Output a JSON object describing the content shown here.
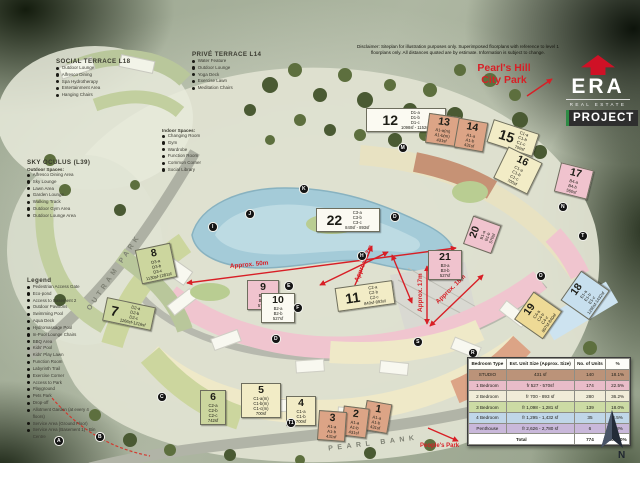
{
  "disclaimer": "Disclaimer: Siteplan for illustration purposes only. Superimposed floorplans with reference to level 1 floorplans only. All distances quoted are by estimate. Information is subject to change.",
  "branding": {
    "era": "ERA",
    "real_estate": "REAL ESTATE",
    "project": "PROJECT"
  },
  "park_labels": {
    "pearls_hill": "Pearl's Hill\nCity Park",
    "peoples_park": "People's Park"
  },
  "roads": {
    "outram": "OUTRAM PARK",
    "pearl_bank": "PEARL BANK"
  },
  "social_terrace": {
    "title": "SOCIAL TERRACE L18",
    "items": [
      "Outdoor Lounge",
      "Alfresco Dining",
      "Spa Hydrotherapy",
      "Entertainment Area",
      "Hanging Chairs"
    ]
  },
  "prive_terrace": {
    "title": "PRIVÉ TERRACE L14",
    "items": [
      "Water Feature",
      "Outdoor Lounge",
      "Yoga Deck",
      "Exercise Lawn",
      "Meditation Chairs"
    ]
  },
  "indoor_spaces": {
    "title": "Indoor Spaces:",
    "items": [
      "Changing Room",
      "Gym",
      "Wardrobe",
      "Function Room",
      "Common Corner",
      "Social Library"
    ]
  },
  "sky_oculus": {
    "title": "SKY OCULUS (L39)",
    "subtitle": "Outdoor Spaces:",
    "items": [
      "Alfresco Dining Area",
      "Sky Lounge",
      "Lawn Area",
      "Garden Lounge",
      "Walking Track",
      "Outdoor Gym Area",
      "Outdoor Lounge Area"
    ]
  },
  "legend": {
    "title": "Legend",
    "items": [
      "Pedestrian Access Gate",
      "Eco-pond",
      "Access to Basement 2",
      "Outdoor Pavilions",
      "Swimming Pool",
      "Aqua Deck",
      "Hydromassage Pool",
      "In-Pool Lounge Chairs",
      "BBQ Area",
      "Kids' Pool",
      "Kids' Play Lawn",
      "Function Room",
      "Labyrinth Trail",
      "Exercise Corner",
      "Access to Park",
      "Playground",
      "Pets Park",
      "Drop-off",
      "Allotment Garden (at every 4 floors)",
      "Service Area (Ground Floor)",
      "Service Area (Basement 1) - Bin Centre"
    ]
  },
  "compass": {
    "label": "N"
  },
  "colors": {
    "accent_red": "#d81f26",
    "era_red": "#cf1126",
    "project_green": "#2e8b44"
  },
  "table": {
    "headers": [
      "Bedroom Type",
      "Est. Unit Size (Approx. Size)",
      "No. of Units",
      "%"
    ],
    "rows": [
      {
        "type": "STUDIO",
        "size": "431 sf",
        "units": "140",
        "pct": "18.1%",
        "color": "#bb9379"
      },
      {
        "type": "1 Bedroom",
        "size": "fr 527 - 570sf",
        "units": "174",
        "pct": "22.5%",
        "color": "#e9bcc9"
      },
      {
        "type": "2 Bedroom",
        "size": "fr 700 - 893 sf",
        "units": "280",
        "pct": "36.2%",
        "color": "#f0ecd8"
      },
      {
        "type": "3 Bedroom",
        "size": "fr 1,098 - 1,281 sf",
        "units": "139",
        "pct": "18.0%",
        "color": "#ccdba4"
      },
      {
        "type": "4 Bedroom",
        "size": "fr 1,295 - 1,432 sf",
        "units": "35",
        "pct": "4.5%",
        "color": "#c0d6e8"
      },
      {
        "type": "Penthouse",
        "size": "fr 2,626 - 2,780 sf",
        "units": "6",
        "pct": "0.8%",
        "color": "#c9b8da"
      }
    ],
    "total_label": "Total",
    "total_units": "774",
    "total_pct": "100.00%"
  },
  "blocks": [
    {
      "n": "1",
      "x": 364,
      "y": 402,
      "w": 20,
      "rot": 10,
      "bg": "#dca486",
      "lines": "A1-a\nA1-b\n431sf"
    },
    {
      "n": "2",
      "x": 342,
      "y": 407,
      "w": 20,
      "rot": 7,
      "bg": "#dca486",
      "lines": "A1-a\nA1-b\n431sf"
    },
    {
      "n": "3",
      "x": 318,
      "y": 411,
      "w": 22,
      "rot": 4,
      "bg": "#dca486",
      "lines": "A1-a\nA1-b\n431sf"
    },
    {
      "n": "4",
      "x": 286,
      "y": 396,
      "w": 24,
      "rot": 0,
      "bg": "#f2ecc6",
      "lines": "C1-a\nC1-b\n700sf"
    },
    {
      "n": "5",
      "x": 241,
      "y": 383,
      "w": 34,
      "rot": 0,
      "bg": "#f2ecc6",
      "lines": "C1-a(m)\nC1-b(m)\nC1-c(m)\n700sf"
    },
    {
      "n": "6",
      "x": 200,
      "y": 390,
      "w": 20,
      "rot": 0,
      "bg": "#ccd69e",
      "lines": "C2-a\nC2-b\nC2-c\n742sf"
    },
    {
      "n": "7",
      "x": 104,
      "y": 302,
      "w": 44,
      "rot": 12,
      "bg": "#ccd69e",
      "dir": "row",
      "lines": "D2-a\nD2-b\nD2-c\n1166sf-1216sf"
    },
    {
      "n": "8",
      "x": 138,
      "y": 246,
      "w": 30,
      "rot": -12,
      "bg": "#ccd69e",
      "lines": "D3-a\nD3-b\nD3-c\n1130sf-1281sf"
    },
    {
      "n": "9",
      "x": 247,
      "y": 280,
      "w": 26,
      "rot": 0,
      "bg": "#f0c3ce",
      "lines": "B1-a\nB1-b\n570sf"
    },
    {
      "n": "10",
      "x": 261,
      "y": 293,
      "w": 28,
      "rot": 0,
      "bg": "#fbfaf2",
      "lines": "B2-a\nB2-b\n527sf"
    },
    {
      "n": "11",
      "x": 336,
      "y": 284,
      "w": 52,
      "rot": -8,
      "bg": "#f2ecc6",
      "dir": "row",
      "lines": "C2-a\nC2-b\nC2-c\n840sf-893sf"
    },
    {
      "n": "12",
      "x": 366,
      "y": 108,
      "w": 74,
      "rot": 0,
      "bg": "#fbfaf2",
      "dir": "row",
      "lines": "D1-a\nD1-b\nD1-c\n1098sf - 1152sf"
    },
    {
      "n": "13",
      "x": 427,
      "y": 115,
      "w": 26,
      "rot": 8,
      "bg": "#dca486",
      "lines": "A1-a(m)\nA1-b(m)\n431sf"
    },
    {
      "n": "14",
      "x": 456,
      "y": 120,
      "w": 24,
      "rot": 10,
      "bg": "#dca486",
      "lines": "A1-a\nA1-b\n431sf"
    },
    {
      "n": "15",
      "x": 489,
      "y": 126,
      "w": 42,
      "rot": 18,
      "bg": "#f2ecc6",
      "dir": "row",
      "lines": "C1-a\nC1-b\nC1-c\n700sf"
    },
    {
      "n": "16",
      "x": 499,
      "y": 153,
      "w": 32,
      "rot": 26,
      "bg": "#f2ecc6",
      "lines": "C1-a\nC1-b\nC1-c\n700sf"
    },
    {
      "n": "17",
      "x": 557,
      "y": 166,
      "w": 28,
      "rot": 14,
      "bg": "#f0c3ce",
      "lines": "B4-a\nB4-b\n560sf"
    },
    {
      "n": "18",
      "x": 567,
      "y": 278,
      "w": 30,
      "rot": -55,
      "bg": "#c7dfee",
      "lines": "E1-a\nE1-b\nE1-c\n1295sf-1432sf"
    },
    {
      "n": "19",
      "x": 521,
      "y": 298,
      "w": 28,
      "rot": -55,
      "bg": "#eeda96",
      "lines": "C4-a\nC4-b\nC4-c\n807sf-840sf"
    },
    {
      "n": "20",
      "x": 467,
      "y": 220,
      "w": 24,
      "rot": -70,
      "bg": "#f0c3ce",
      "lines": "B1-a\nB1-b\n570sf"
    },
    {
      "n": "21",
      "x": 428,
      "y": 250,
      "w": 28,
      "rot": 0,
      "bg": "#f0c3ce",
      "lines": "B3-a\nB3-b\n527sf"
    },
    {
      "n": "22",
      "x": 316,
      "y": 208,
      "w": 58,
      "rot": 0,
      "bg": "#fbfaf2",
      "dir": "row",
      "lines": "C3-a\nC3-b\nC3-c\n840sf - 893sf"
    }
  ],
  "badges": [
    {
      "t": "A",
      "x": 54,
      "y": 436
    },
    {
      "t": "B",
      "x": 95,
      "y": 432
    },
    {
      "t": "C",
      "x": 157,
      "y": 392
    },
    {
      "t": "D",
      "x": 271,
      "y": 334
    },
    {
      "t": "D",
      "x": 390,
      "y": 212
    },
    {
      "t": "E",
      "x": 284,
      "y": 281
    },
    {
      "t": "F",
      "x": 293,
      "y": 303
    },
    {
      "t": "H",
      "x": 357,
      "y": 251
    },
    {
      "t": "I",
      "x": 208,
      "y": 222
    },
    {
      "t": "J",
      "x": 245,
      "y": 209
    },
    {
      "t": "K",
      "x": 299,
      "y": 184
    },
    {
      "t": "M",
      "x": 398,
      "y": 143
    },
    {
      "t": "N",
      "x": 558,
      "y": 202
    },
    {
      "t": "O",
      "x": 536,
      "y": 271
    },
    {
      "t": "R",
      "x": 468,
      "y": 348
    },
    {
      "t": "S",
      "x": 413,
      "y": 337
    },
    {
      "t": "T",
      "x": 578,
      "y": 231
    },
    {
      "t": "T1",
      "x": 286,
      "y": 418
    }
  ],
  "arrows": [
    {
      "x1": 187,
      "y1": 283,
      "x2": 456,
      "y2": 248,
      "both": true,
      "label": "Approx. 50m",
      "lx": 230,
      "ly": 268,
      "lrot": -5
    },
    {
      "x1": 372,
      "y1": 246,
      "x2": 352,
      "y2": 292,
      "both": true,
      "label": "Approx. 12m",
      "lx": 358,
      "ly": 282,
      "lrot": -68
    },
    {
      "x1": 427,
      "y1": 266,
      "x2": 427,
      "y2": 324,
      "both": true,
      "label": "Approx. 17m",
      "lx": 422,
      "ly": 312,
      "lrot": -90
    },
    {
      "x1": 430,
      "y1": 326,
      "x2": 483,
      "y2": 275,
      "both": true,
      "label": "Approx. 18m",
      "lx": 438,
      "ly": 304,
      "lrot": -44
    },
    {
      "x1": 388,
      "y1": 252,
      "x2": 320,
      "y2": 285,
      "both": true
    },
    {
      "x1": 392,
      "y1": 255,
      "x2": 412,
      "y2": 303,
      "both": true
    },
    {
      "x1": 527,
      "y1": 96,
      "x2": 552,
      "y2": 79,
      "both": false
    },
    {
      "x1": 428,
      "y1": 428,
      "x2": 458,
      "y2": 441,
      "both": false
    }
  ]
}
